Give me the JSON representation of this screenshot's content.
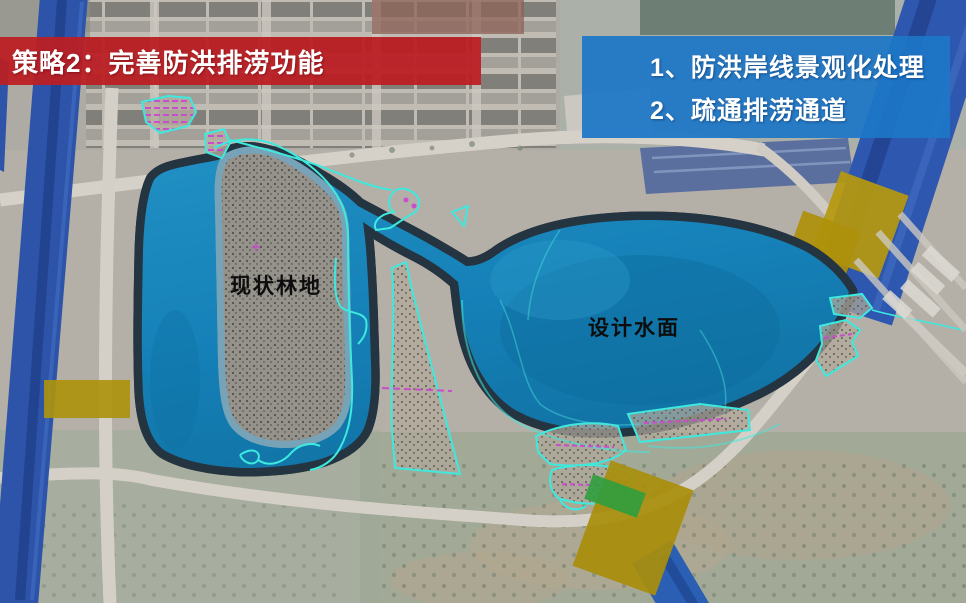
{
  "header": {
    "banner": {
      "label": "策略2：完善防洪排涝功能",
      "bg_color": "#bb1f24f2"
    },
    "notes": {
      "bg_color": "#1d76c6ee",
      "items": [
        "1、防洪岸线景观化处理",
        "2、疏通排涝通道"
      ]
    }
  },
  "map": {
    "labels": {
      "existing_forest": "现状林地",
      "design_water": "设计水面"
    },
    "legend_colors": {
      "design_water_fill": "#1682ba",
      "shore_band": "#76a3b8",
      "water_outline": "#243440",
      "river_channel": "#2d54a9",
      "road_crossing_highlight": "#b2950e",
      "greenway_strip": "#2f9e3e",
      "boundary_line_cyan": "#3ee9de",
      "marking_magenta": "#c94ecb",
      "existing_forest_fill": "#95928b"
    }
  }
}
